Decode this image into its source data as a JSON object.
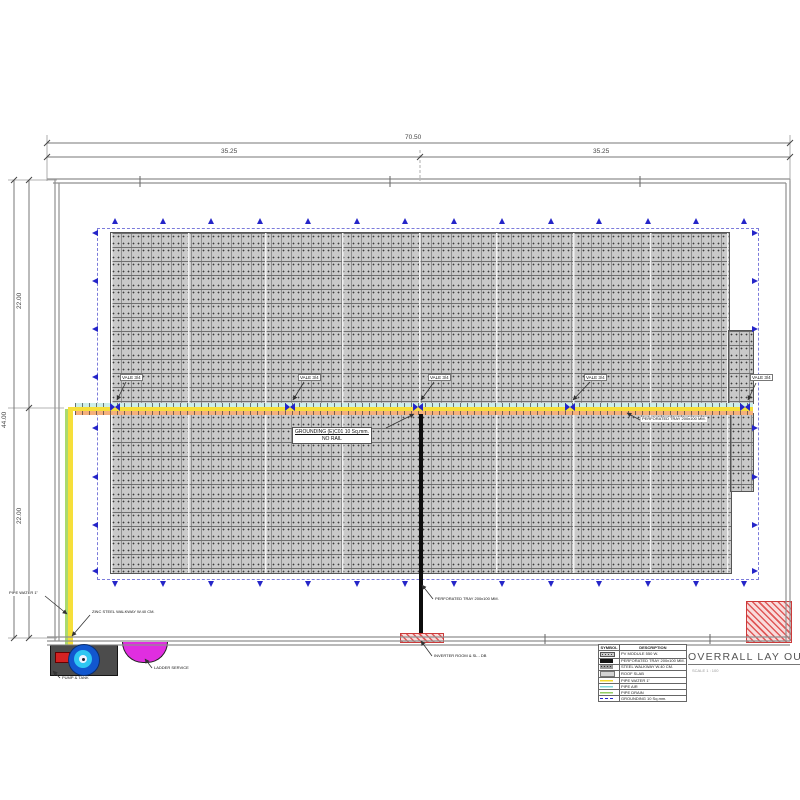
{
  "dimensions": {
    "overall_width": "70.50",
    "left_half": "35.25",
    "right_half": "35.25",
    "overall_height": "44.00",
    "upper_half": "22.00",
    "lower_half": "22.00"
  },
  "labels": {
    "valve": "VALE 3/4",
    "grounding_line1": "GROUNDING (E)C01  10 Sq.mm.",
    "grounding_line2": "NO RAIL",
    "perforated_tray": "PERFORATED TRAY 200x100 MM.",
    "inverter_room": "INVERTER ROOM & SL - DB",
    "walkway": "ZINC STEEL WALKWAY W.40 CM.",
    "pipe_water": "PIPE WATER 1\"",
    "ladder_service": "LADDER SERVICE",
    "pump_tank": "PUMP & TANK"
  },
  "title": {
    "text": "OVERRALL LAY OUT",
    "scale": "SCALE 1 : 100"
  },
  "legend": {
    "headers": {
      "symbol": "SYMBOL",
      "description": "DESCRIPTION"
    },
    "rows": [
      {
        "swatch": "panel",
        "description": "PV MODULE 550 W."
      },
      {
        "swatch": "black",
        "description": "PERFORATED TRAY 200x100 MM."
      },
      {
        "swatch": "gray-dot",
        "description": "STEEL WALKWAY W.40 CM."
      },
      {
        "swatch": "gray",
        "description": "ROOF SLAB"
      },
      {
        "swatch": "yellow-line",
        "description": "PIPE WATER 1\""
      },
      {
        "swatch": "cyan-line",
        "description": "PIPE AIR"
      },
      {
        "swatch": "green-line",
        "description": "PIPE DRAIN"
      },
      {
        "swatch": "blue-dash",
        "description": "GROUNDING 10 Sq.mm."
      }
    ]
  },
  "colors": {
    "marker_blue": "#2525c8",
    "pipe_yellow": "#f6df3a",
    "pipe_cyan": "#cdeee9",
    "pipe_salmon": "#f5b07c",
    "pipe_green": "#aada6e",
    "magenta": "#e02ee0",
    "hatch_red": "#e05858"
  }
}
